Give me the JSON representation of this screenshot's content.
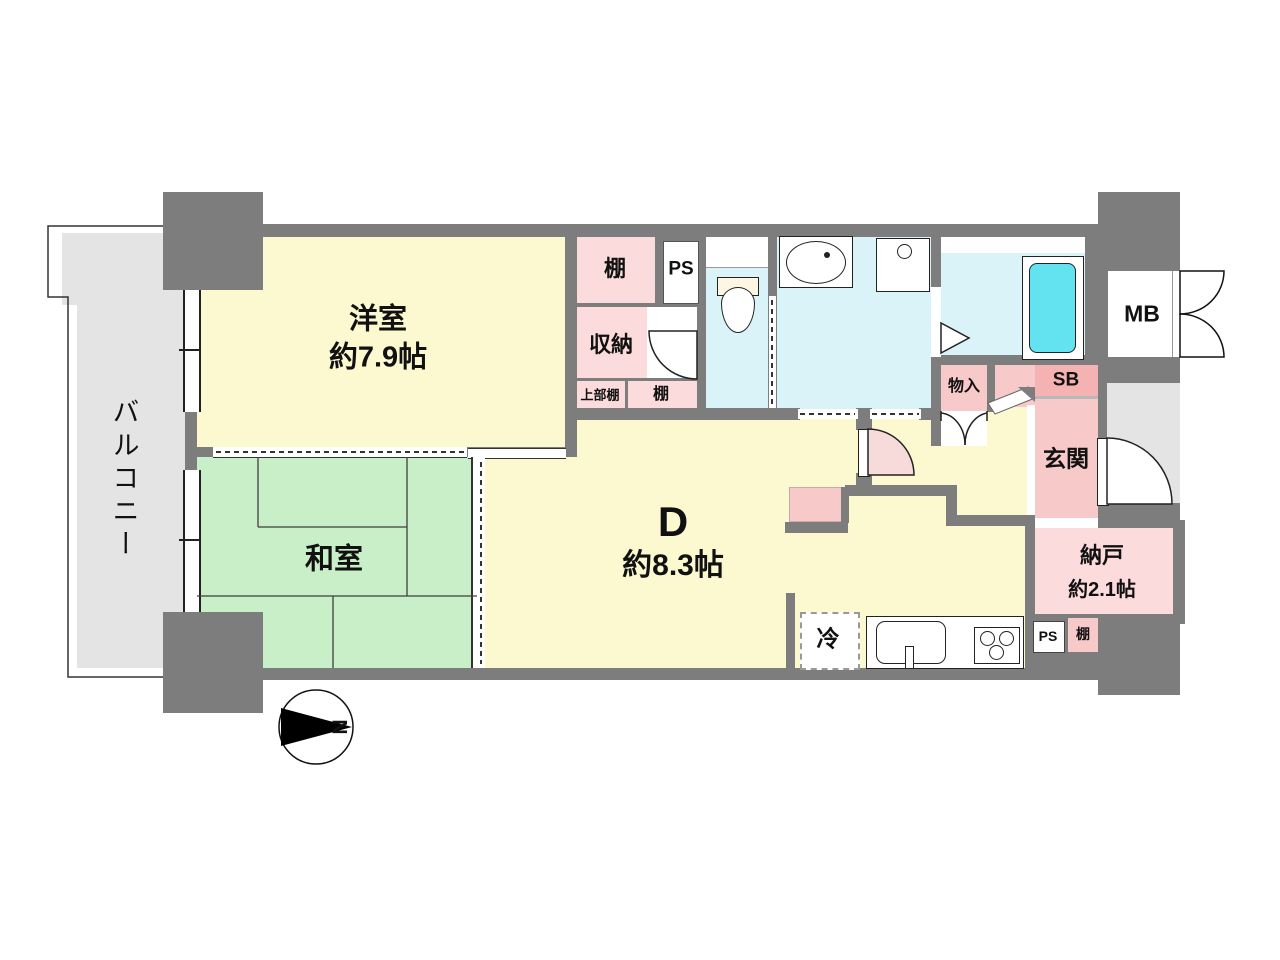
{
  "palette": {
    "wall": "#7d7d7d",
    "balcony": "#e4e4e4",
    "corridor": "#e4e4e4",
    "room-yellow": "#fcf9d0",
    "tatami-green": "#c9efc9",
    "water-blue": "#d9f3f8",
    "tub-cyan": "#63e3ef",
    "pink-light": "#fbdbdb",
    "pink-mid": "#f7c9c9",
    "pink-dark": "#f5b2b2",
    "door-swing-pink": "#f7dada",
    "line": "#333333"
  },
  "labels": {
    "balcony": "バルコニー",
    "western_room": {
      "name": "洋室",
      "size": "約7.9帖"
    },
    "japanese_room": {
      "name": "和室"
    },
    "dining": {
      "name": "D",
      "size": "約8.3帖"
    },
    "closet": "収納",
    "shelf_top": "棚",
    "upper_shelf": "上部棚",
    "shelf_mid": "棚",
    "ps_top": "PS",
    "storage_small": "物入",
    "sb": "SB",
    "mb": "MB",
    "entrance": "玄関",
    "storage_room": {
      "name": "納戸",
      "size": "約2.1帖"
    },
    "ps_bottom": "PS",
    "shelf_bottom": "棚",
    "fridge": "冷",
    "compass_north": "N"
  }
}
